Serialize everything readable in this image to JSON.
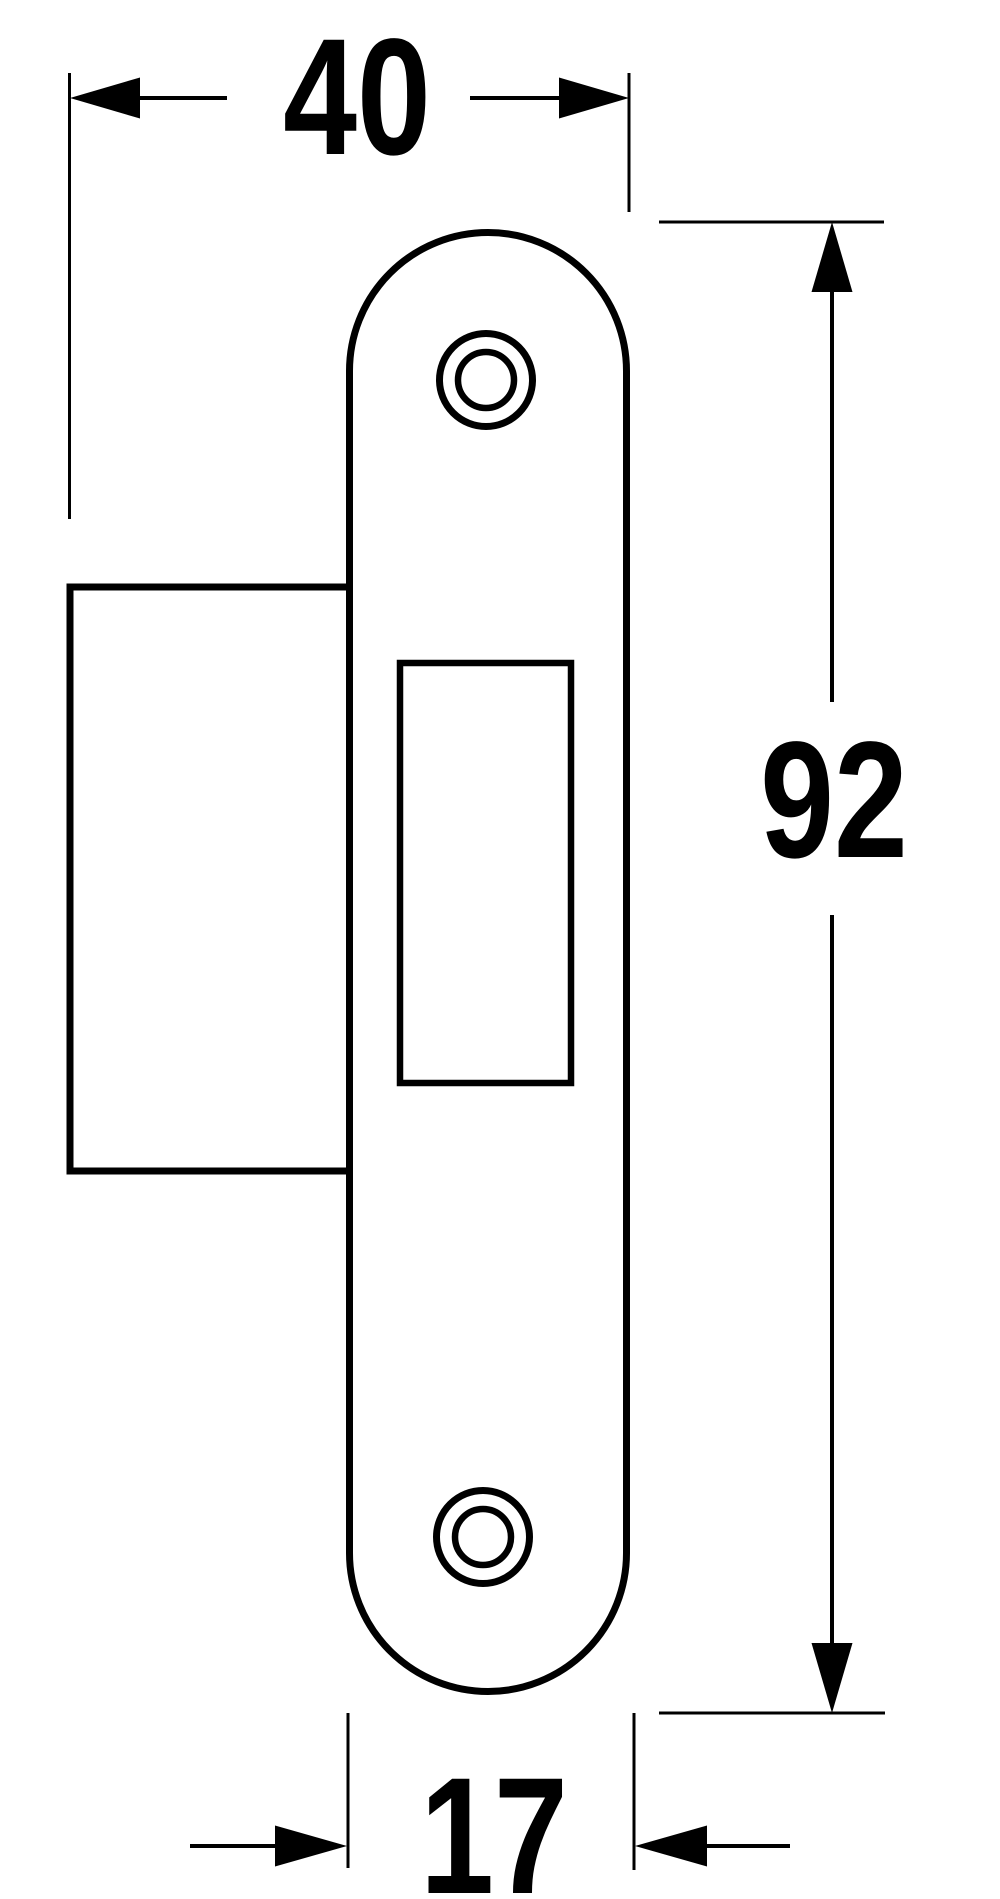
{
  "diagram": {
    "background": "#ffffff",
    "line_color": "#000000",
    "part": "strike-plate-front-view",
    "dimensions": {
      "top": {
        "label": "40",
        "value": 40
      },
      "right": {
        "label": "92",
        "value": 92
      },
      "bottom": {
        "label": "17",
        "value": 17
      }
    }
  }
}
